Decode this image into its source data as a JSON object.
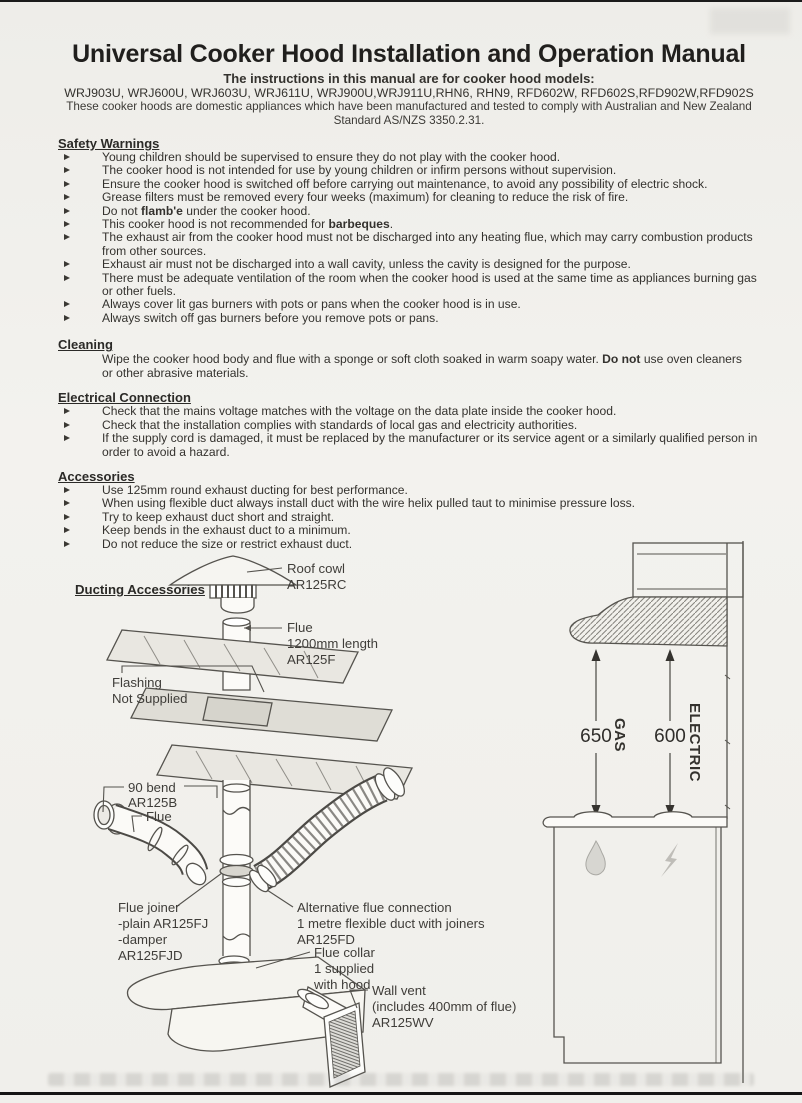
{
  "header": {
    "title": "Universal Cooker Hood Installation and Operation Manual",
    "subtitle": "The instructions in this manual are for cooker hood models:",
    "models": "WRJ903U, WRJ600U, WRJ603U, WRJ611U, WRJ900U,WRJ911U,RHN6, RHN9, RFD602W, RFD602S,RFD902W,RFD902S",
    "compliance_line1": "These cooker hoods are domestic appliances which have been manufactured and tested to comply with Australian and New Zealand",
    "compliance_line2": "Standard AS/NZS 3350.2.31."
  },
  "safety": {
    "heading": "Safety Warnings",
    "items": [
      {
        "pre": "Young children should be supervised to ensure they do not play with the cooker hood."
      },
      {
        "pre": "The cooker hood is not intended for use by young children or infirm persons without supervision."
      },
      {
        "pre": "Ensure the cooker hood is switched off before carrying out maintenance, to avoid any possibility of electric shock."
      },
      {
        "pre": "Grease filters must be removed every four weeks (maximum) for cleaning to reduce the risk of fire."
      },
      {
        "pre": "Do not ",
        "bold": "flamb'e",
        "post": " under the cooker hood."
      },
      {
        "pre": "This cooker hood is not recommended for ",
        "bold": "barbeques",
        "post": "."
      },
      {
        "pre": "The exhaust air from the cooker hood must not be discharged into any heating flue, which may carry combustion products from other sources."
      },
      {
        "pre": "Exhaust air must not be discharged into a wall cavity, unless the cavity is designed for the purpose."
      },
      {
        "pre": "There must be adequate ventilation of the room when the cooker hood is used at the same time as appliances burning gas or other fuels."
      },
      {
        "pre": "Always cover lit gas burners with pots or pans when the cooker hood is in use."
      },
      {
        "pre": "Always switch off gas burners before you remove pots or pans."
      }
    ]
  },
  "cleaning": {
    "heading": "Cleaning",
    "body": {
      "pre": "Wipe the cooker hood body and flue with a sponge or soft cloth soaked in warm soapy water. ",
      "bold": "Do not",
      "post": " use oven cleaners or other abrasive materials."
    }
  },
  "electrical": {
    "heading": "Electrical Connection",
    "items": [
      {
        "pre": "Check that the mains voltage matches with the voltage on the data plate inside the cooker hood."
      },
      {
        "pre": "Check that the installation complies with standards of local gas and electricity authorities."
      },
      {
        "pre": "If the supply cord is damaged, it must be replaced by the manufacturer or its service agent or a similarly qualified person in order to avoid a hazard."
      }
    ]
  },
  "accessories": {
    "heading": "Accessories",
    "items": [
      {
        "pre": "Use 125mm round exhaust ducting for best performance."
      },
      {
        "pre": "When using flexible duct always install duct with the wire helix pulled taut to minimise pressure loss."
      },
      {
        "pre": "Try to keep exhaust duct short and straight."
      },
      {
        "pre": "Keep bends in the exhaust duct to a minimum."
      },
      {
        "pre": "Do not reduce the size or restrict exhaust duct."
      }
    ]
  },
  "ducting": {
    "heading": "Ducting Accessories",
    "labels": {
      "roof_cowl": [
        "Roof cowl",
        "AR125RC"
      ],
      "flue_top": [
        "Flue",
        "1200mm length",
        "AR125F"
      ],
      "flashing": [
        "Flashing",
        "Not Supplied"
      ],
      "bend": [
        "90  bend",
        "AR125B"
      ],
      "flue_side": "Flue",
      "flue_joiner": [
        "Flue joiner",
        "-plain AR125FJ",
        "-damper",
        "AR125FJD"
      ],
      "alt_flue": [
        "Alternative flue connection",
        "1 metre flexible duct with joiners",
        "AR125FD"
      ],
      "flue_collar": [
        "Flue collar",
        "1 supplied",
        "with hood"
      ],
      "wall_vent": [
        "Wall vent",
        "(includes 400mm of flue)",
        "AR125WV"
      ]
    }
  },
  "clearance": {
    "gas_value": "650",
    "gas_label": "GAS",
    "electric_value": "600",
    "electric_label": "ELECTRIC"
  },
  "icons": {
    "bullet": "right-arrow-triangle",
    "gas": "water-droplet",
    "electric": "lightning-bolt"
  },
  "colors": {
    "paper": "#f1f0ec",
    "ink": "#34322e"
  }
}
